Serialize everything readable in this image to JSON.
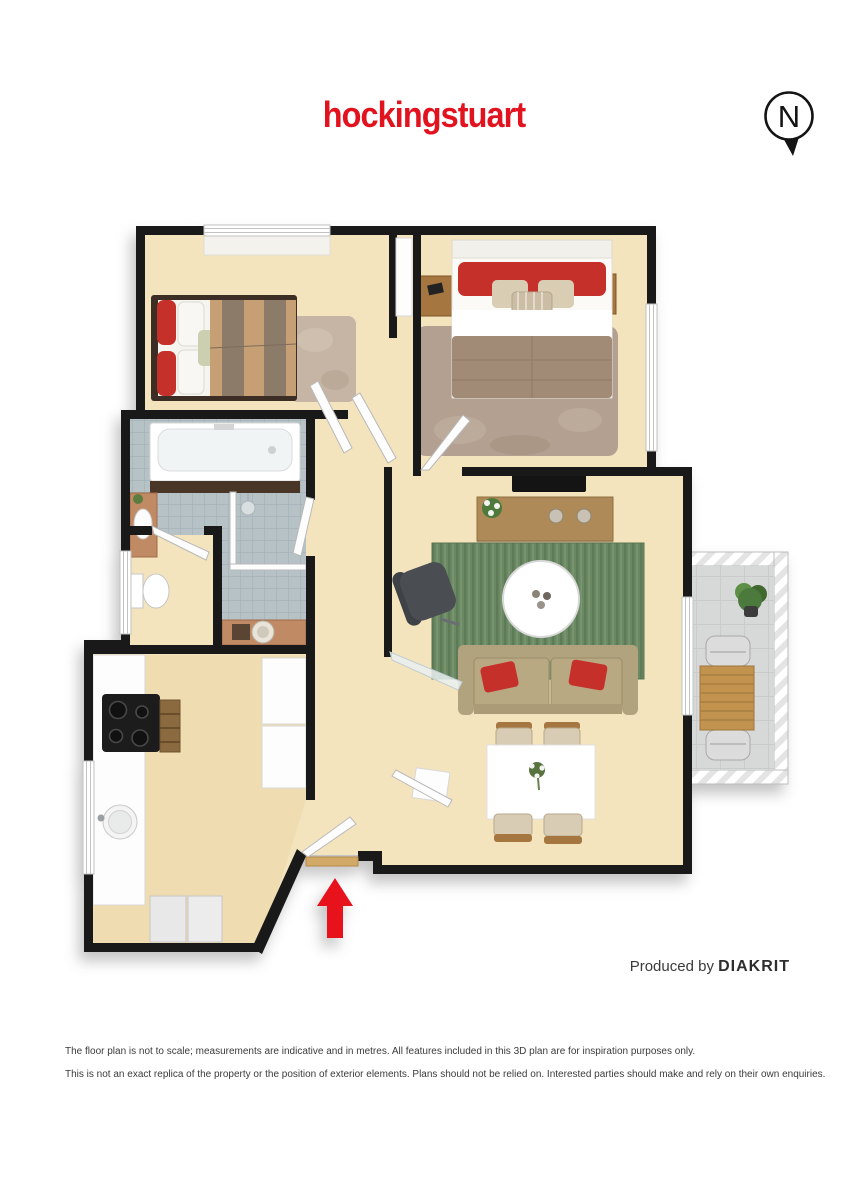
{
  "header": {
    "logo_text": "hockingstuart",
    "compass_label": "N"
  },
  "footer": {
    "produced_by_prefix": "Produced by ",
    "produced_by_brand": "DIAKRIT"
  },
  "disclaimer": {
    "line1": "The floor plan is not to scale; measurements are indicative and in metres. All features included in this 3D plan are for inspiration purposes only.",
    "line2": "This is not an exact replica of the property or the position of exterior elements. Plans should not be relied on. Interested parties should make and rely on their own enquiries."
  },
  "colors": {
    "brand_red": "#e2121e",
    "arrow_red": "#e8121c",
    "wall_black": "#191919",
    "floor_cream": "#f3e4bd",
    "tile_gray": "#b7c2c7",
    "balcony_gray": "#d7d9d9",
    "rug_green": "#6b8a64",
    "rug_taupe": "#b3a091",
    "rug_beige": "#c6b5a4",
    "sofa_tan": "#b2a37f",
    "wood_brown": "#ad8a57",
    "terracotta": "#c08a64",
    "pillow_red": "#c6302b"
  }
}
